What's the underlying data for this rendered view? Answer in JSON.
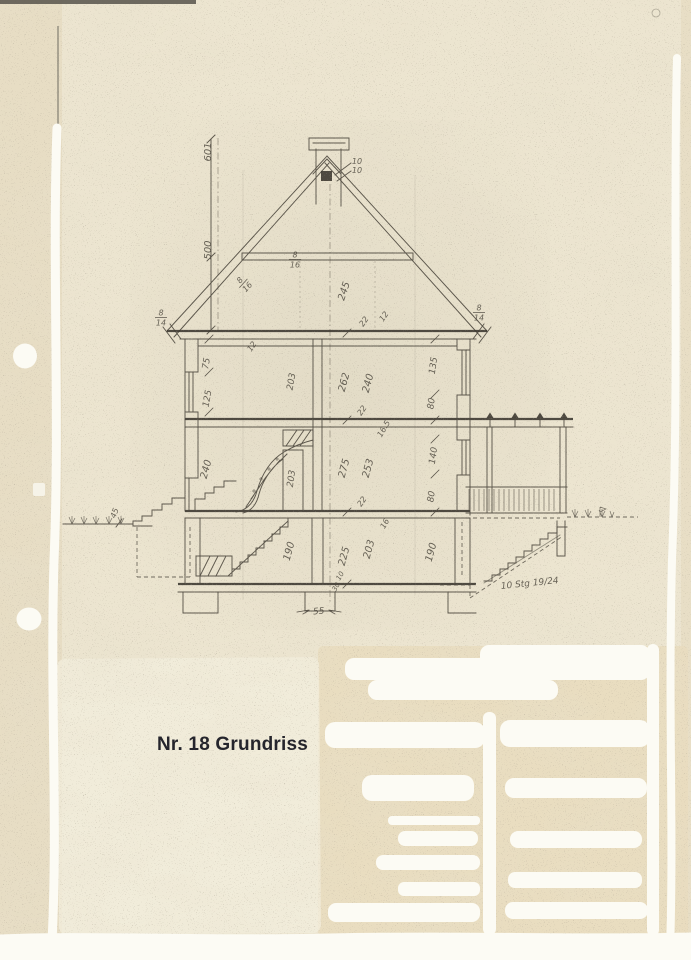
{
  "title_block": {
    "text": "Nr. 18 Grundriss"
  },
  "colors": {
    "paper": "#ece5d0",
    "paper-strip": "#e3d7ba",
    "paper-footer": "#e9dcbd",
    "paper-light": "#f3eedd",
    "ink": "#4f4a40",
    "ink-dark": "#3d3831",
    "white": "#fcfbf4",
    "title-color": "#25252c"
  },
  "drawing": {
    "labels": [
      {
        "t": "601",
        "x": 211,
        "y": 152,
        "r": -90,
        "s": 10
      },
      {
        "t": "500",
        "x": 211,
        "y": 250,
        "r": -90,
        "s": 10
      },
      {
        "t": "10",
        "x": 357,
        "y": 164,
        "r": 0,
        "s": 8
      },
      {
        "t": "10",
        "x": 357,
        "y": 173,
        "r": 0,
        "s": 8
      },
      {
        "t": "8/16",
        "x": 295,
        "y": 259,
        "r": 0,
        "s": 8,
        "frac": true
      },
      {
        "t": "8/16",
        "x": 243,
        "y": 283,
        "r": -48,
        "s": 8,
        "frac": true
      },
      {
        "t": "8/14",
        "x": 161,
        "y": 317,
        "r": 0,
        "s": 8,
        "frac": true
      },
      {
        "t": "8/14",
        "x": 479,
        "y": 312,
        "r": 0,
        "s": 8,
        "frac": true
      },
      {
        "t": "245",
        "x": 347,
        "y": 292,
        "r": -72,
        "s": 10
      },
      {
        "t": "22",
        "x": 366,
        "y": 323,
        "r": -55,
        "s": 8
      },
      {
        "t": "12",
        "x": 386,
        "y": 318,
        "r": -55,
        "s": 8
      },
      {
        "t": "75",
        "x": 209,
        "y": 364,
        "r": -80,
        "s": 9
      },
      {
        "t": "125",
        "x": 210,
        "y": 399,
        "r": -80,
        "s": 9
      },
      {
        "t": "12",
        "x": 254,
        "y": 348,
        "r": -55,
        "s": 8
      },
      {
        "t": "203",
        "x": 294,
        "y": 382,
        "r": -80,
        "s": 9
      },
      {
        "t": "262",
        "x": 347,
        "y": 383,
        "r": -75,
        "s": 10
      },
      {
        "t": "240",
        "x": 371,
        "y": 384,
        "r": -75,
        "s": 10
      },
      {
        "t": "22",
        "x": 364,
        "y": 412,
        "r": -55,
        "s": 8
      },
      {
        "t": "16.5",
        "x": 386,
        "y": 430,
        "r": -60,
        "s": 8
      },
      {
        "t": "135",
        "x": 436,
        "y": 366,
        "r": -82,
        "s": 9
      },
      {
        "t": "80",
        "x": 434,
        "y": 404,
        "r": -82,
        "s": 9
      },
      {
        "t": "240",
        "x": 209,
        "y": 470,
        "r": -75,
        "s": 10
      },
      {
        "t": "203",
        "x": 294,
        "y": 479,
        "r": -82,
        "s": 9
      },
      {
        "t": "275",
        "x": 347,
        "y": 469,
        "r": -75,
        "s": 10
      },
      {
        "t": "253",
        "x": 371,
        "y": 469,
        "r": -75,
        "s": 10
      },
      {
        "t": "140",
        "x": 436,
        "y": 456,
        "r": -82,
        "s": 9
      },
      {
        "t": "80",
        "x": 434,
        "y": 497,
        "r": -82,
        "s": 9
      },
      {
        "t": "22",
        "x": 364,
        "y": 503,
        "r": -55,
        "s": 8
      },
      {
        "t": "16",
        "x": 387,
        "y": 525,
        "r": -60,
        "s": 8
      },
      {
        "t": "190",
        "x": 292,
        "y": 552,
        "r": -75,
        "s": 10
      },
      {
        "t": "225",
        "x": 347,
        "y": 557,
        "r": -75,
        "s": 10
      },
      {
        "t": "203",
        "x": 372,
        "y": 550,
        "r": -75,
        "s": 10
      },
      {
        "t": "190",
        "x": 434,
        "y": 553,
        "r": -75,
        "s": 10
      },
      {
        "t": "10",
        "x": 342,
        "y": 577,
        "r": -60,
        "s": 7
      },
      {
        "t": "30",
        "x": 338,
        "y": 588,
        "r": -60,
        "s": 7
      },
      {
        "t": "55",
        "x": 319,
        "y": 614,
        "r": -5,
        "s": 9
      },
      {
        "t": "45",
        "x": 117,
        "y": 514,
        "r": -70,
        "s": 8
      },
      {
        "t": "10 Stg 19/24",
        "x": 530,
        "y": 586,
        "r": -6,
        "s": 9
      }
    ]
  }
}
